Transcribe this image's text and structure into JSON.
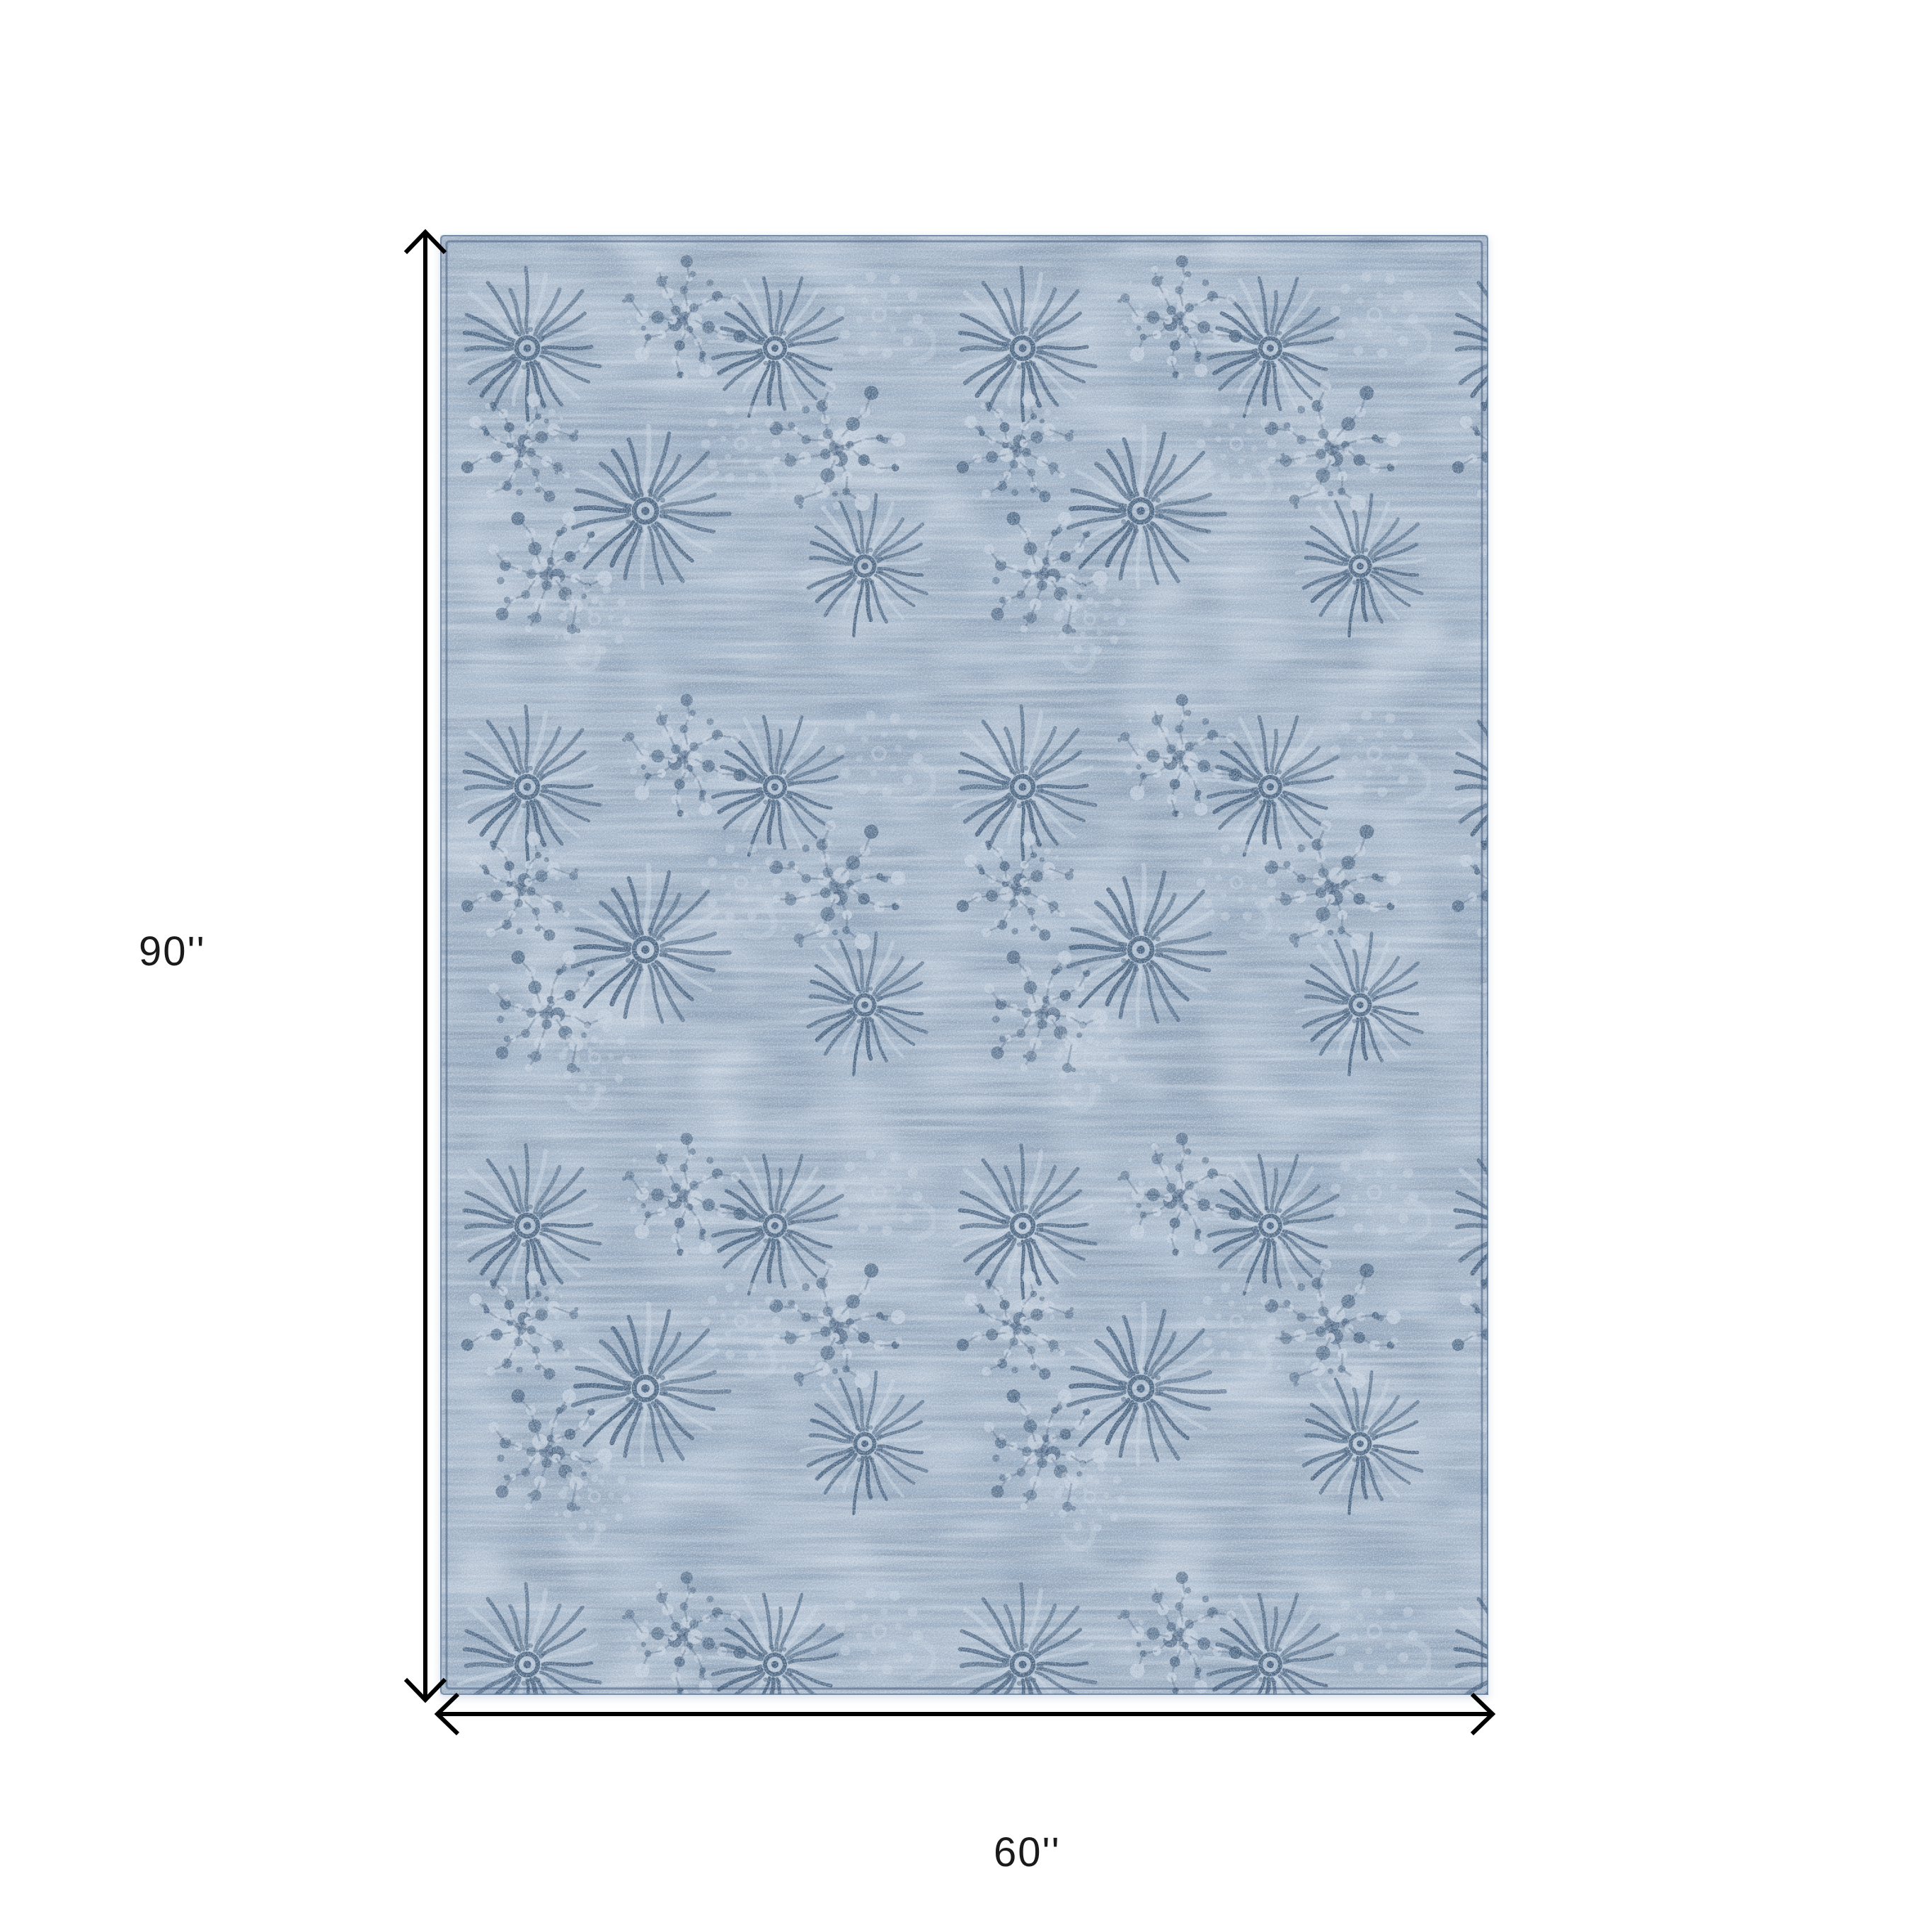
{
  "diagram": {
    "height_label": "90''",
    "width_label": "60''",
    "label_color": "#1a1a1a",
    "arrow_color": "#000000"
  },
  "rug": {
    "description": "distressed blue floral medallion area rug",
    "base_color": "#8da0b5",
    "dark_band_color": "#7289a3",
    "light_speckle_color": "#c8d1db",
    "motif_dark_color": "#35516f",
    "motif_light_color": "#ccd6e2",
    "seam_color": "#3d567a",
    "edge_color": "#6a82a0"
  }
}
